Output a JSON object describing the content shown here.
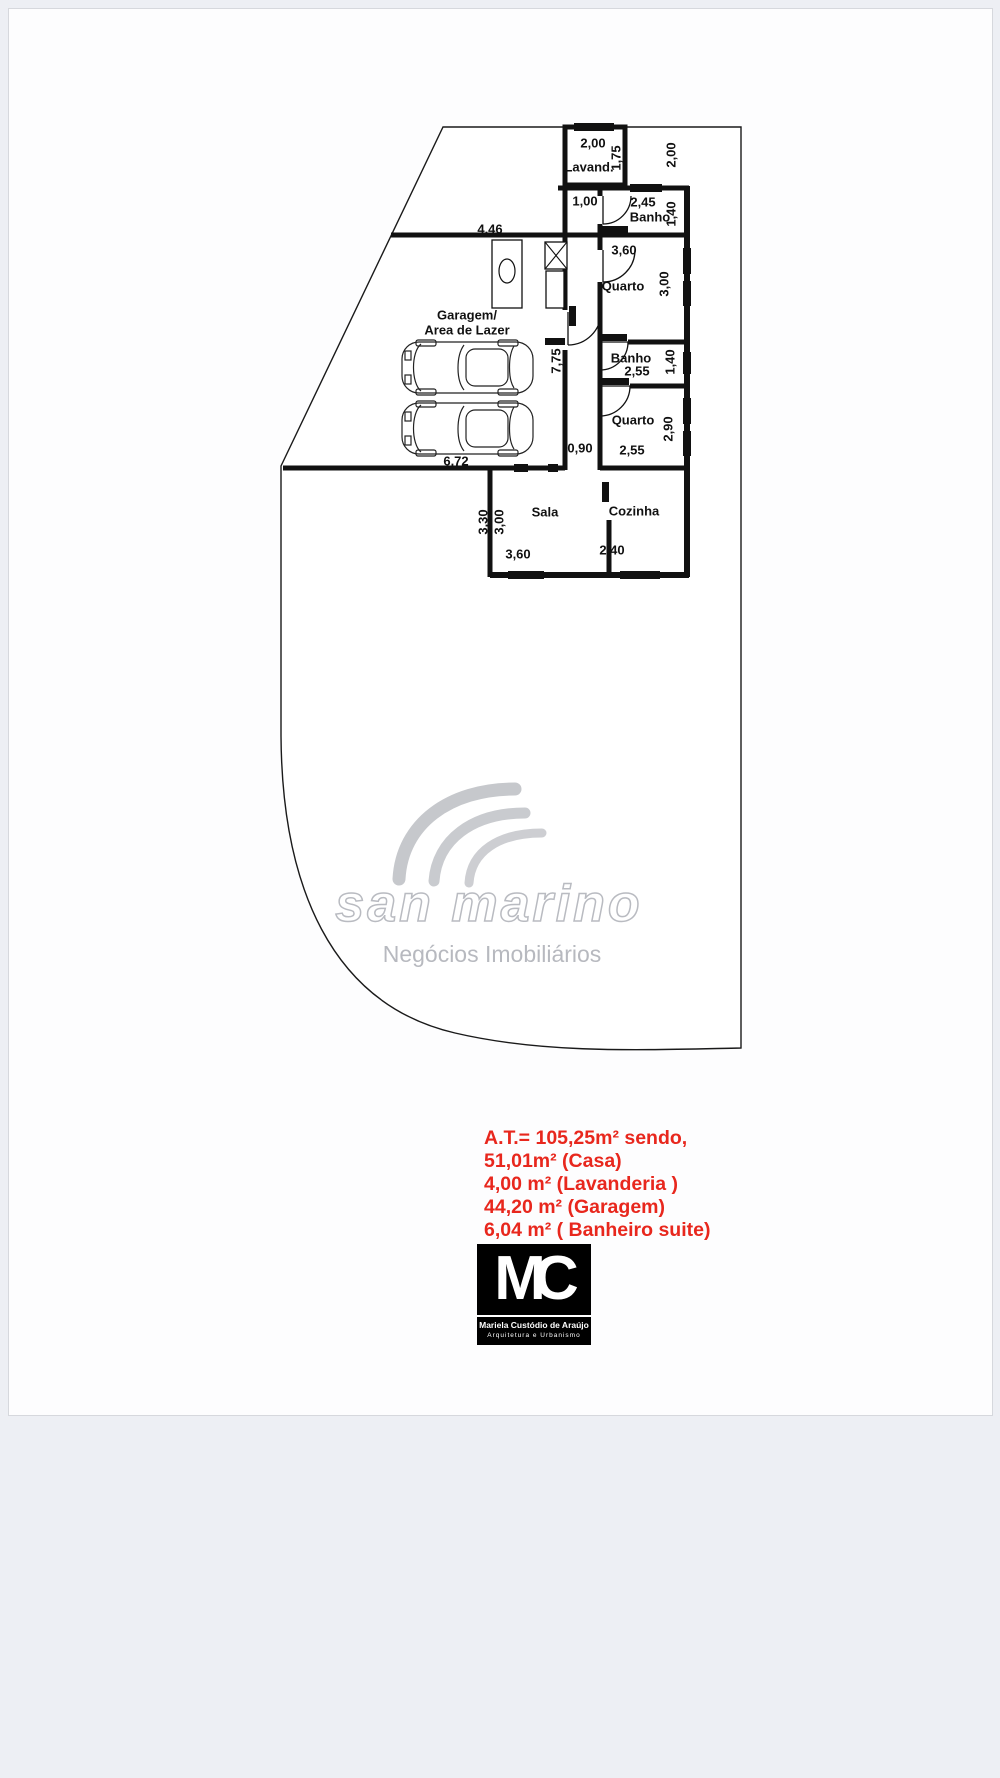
{
  "colors": {
    "ink": "#111111",
    "red": "#e8271d",
    "watermark_gray": "#b9bbc1"
  },
  "labels": {
    "dim_446": "4,46",
    "lavand_title": "Lavand.",
    "lavand_w": "2,00",
    "lavand_h": "1,75",
    "setback_right": "2,00",
    "hall_top_w": "1,00",
    "banho_suite_w": "2,45",
    "banho_suite_title": "Banho",
    "banho_suite_h": "1,40",
    "quarto_suite_w": "3,60",
    "quarto_suite_title": "Quarto",
    "quarto_suite_h": "3,00",
    "garagem_line1": "Garagem/",
    "garagem_line2": "Area de Lazer",
    "garagem_h": "7,75",
    "garagem_w": "6,72",
    "banho2_title": "Banho",
    "banho2_w": "2,55",
    "banho2_h": "1,40",
    "quarto2_title": "Quarto",
    "quarto2_w": "2,55",
    "quarto2_h": "2,90",
    "corridor_w": "0,90",
    "sala_title": "Sala",
    "sala_h_outer": "3,30",
    "sala_h_inner": "3,00",
    "sala_w": "3,60",
    "cozinha_title": "Cozinha",
    "cozinha_w": "2,40"
  },
  "watermark": {
    "brand": "san marino",
    "tagline": "Negócios Imobiliários"
  },
  "areas": {
    "lines": [
      "A.T.= 105,25m² sendo,",
      "51,01m² (Casa)",
      "4,00 m² (Lavanderia )",
      "44,20 m² (Garagem)",
      "6,04 m² ( Banheiro suite)"
    ]
  },
  "logo": {
    "letter_m": "M",
    "letter_c": "C",
    "name": "Mariela Custódio de Araújo",
    "subtitle": "Arquitetura e Urbanismo"
  }
}
